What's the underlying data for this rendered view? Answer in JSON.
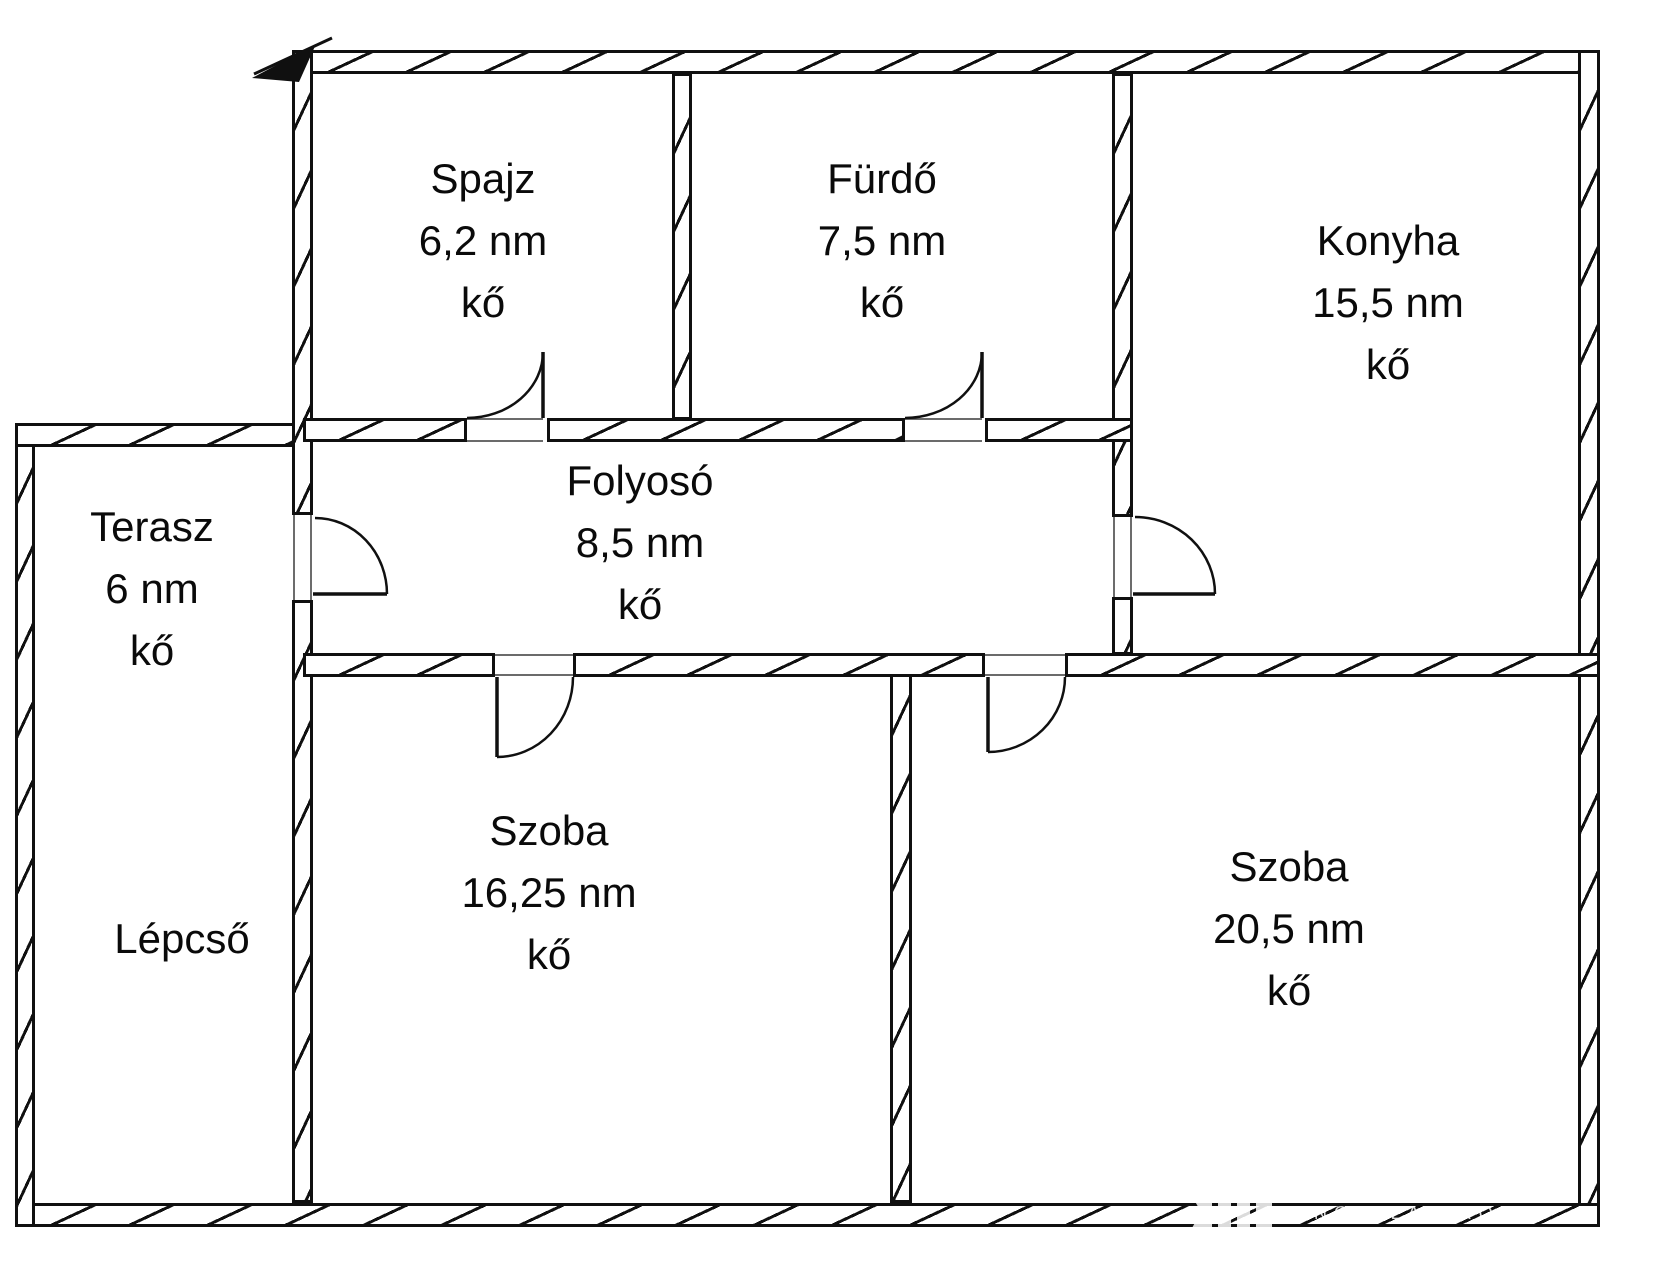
{
  "plan": {
    "background": "#ffffff",
    "wall_color": "#101010",
    "rooms": [
      {
        "id": "spajz",
        "name": "Spajz",
        "area": "6,2 nm",
        "floor": "kő"
      },
      {
        "id": "furdo",
        "name": "Fürdő",
        "area": "7,5 nm",
        "floor": "kő"
      },
      {
        "id": "konyha",
        "name": "Konyha",
        "area": "15,5 nm",
        "floor": "kő"
      },
      {
        "id": "folyoso",
        "name": "Folyosó",
        "area": "8,5 nm",
        "floor": "kő"
      },
      {
        "id": "terasz",
        "name": "Terasz",
        "area": "6 nm",
        "floor": "kő"
      },
      {
        "id": "lepcso",
        "name": "Lépcső"
      },
      {
        "id": "szoba-1",
        "name": "Szoba",
        "area": "16,25 nm",
        "floor": "kő"
      },
      {
        "id": "szoba-2",
        "name": "Szoba",
        "area": "20,5 nm",
        "floor": "kő"
      }
    ],
    "watermark": {
      "text": "INGATLANIRODA",
      "color": "#ffffff"
    }
  }
}
